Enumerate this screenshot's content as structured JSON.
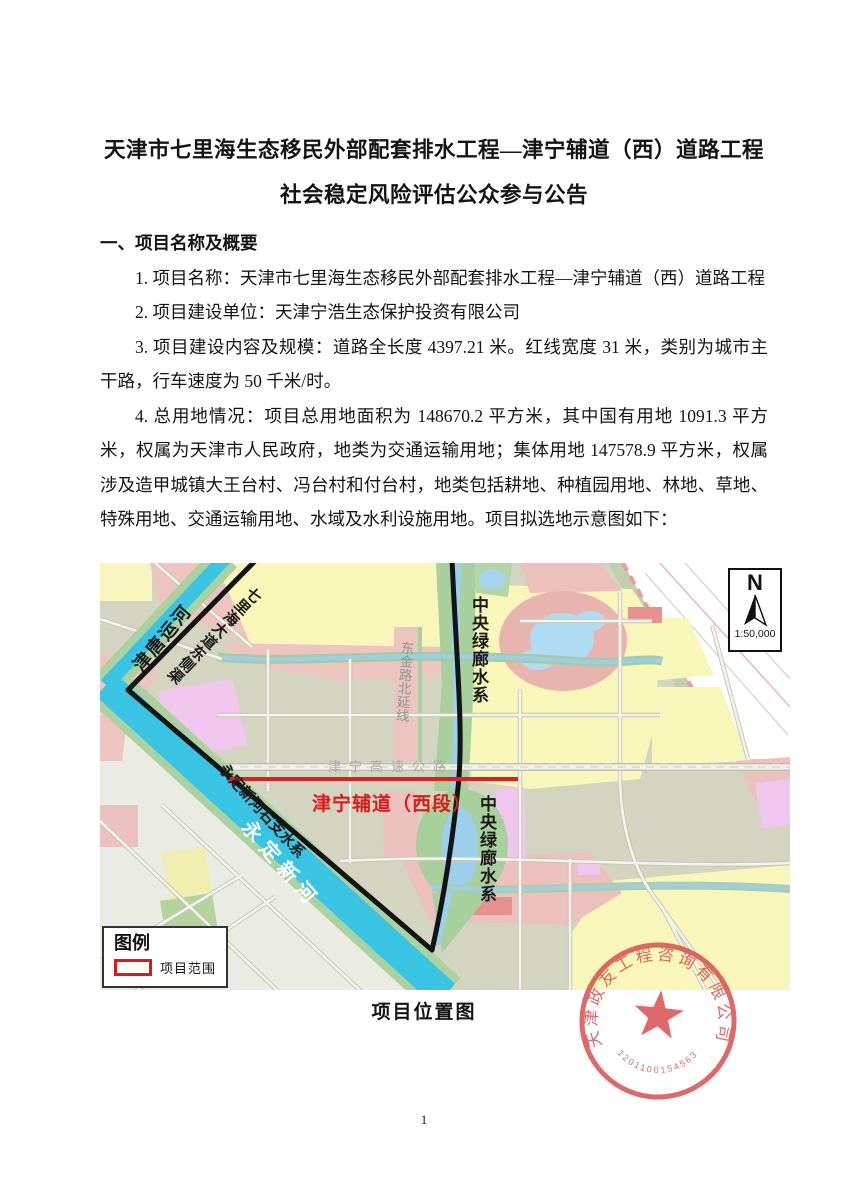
{
  "doc": {
    "title1": "天津市七里海生态移民外部配套排水工程—津宁辅道（西）道路工程",
    "title2": "社会稳定风险评估公众参与公告",
    "heading": "一、项目名称及概要",
    "p1": "1. 项目名称：天津市七里海生态移民外部配套排水工程—津宁辅道（西）道路工程",
    "p2": "2. 项目建设单位：天津宁浩生态保护投资有限公司",
    "p3": "3. 项目建设内容及规模：道路全长度 4397.21 米。红线宽度 31 米，类别为城市主干路，行车速度为 50 千米/时。",
    "p4": "4. 总用地情况：项目总用地面积为 148670.2 平方米，其中国有用地 1091.3 平方米，权属为天津市人民政府，地类为交通运输用地；集体用地 147578.9 平方米，权属涉及造甲城镇大王台村、冯台村和付台村，地类包括耕地、种植园用地、林地、草地、特殊用地、交通运输用地、水域及水利设施用地。项目拟选地示意图如下：",
    "caption": "项目位置图",
    "page_number": "1"
  },
  "map": {
    "labels": {
      "jintang_canal": "津唐运河",
      "qilihai_east_channel": "七里海大道东侧渠",
      "central_green_corridor": "中央绿廊水系",
      "dongjin_road_ext": "东金路北延线",
      "jinning_expressway": "津宁高速公路",
      "project_road": "津宁辅道（西段）",
      "yongding_right_branch": "永定新河右支水系",
      "yongding_river": "永定新河"
    },
    "north": "N",
    "scale": "1:50,000",
    "legend": {
      "title": "图例",
      "item": "项目范围"
    },
    "colors": {
      "project_line": "#df1f1f",
      "boundary": "#141414",
      "river": "#3ac4e4",
      "seal": "#d94848"
    }
  },
  "stamp": {
    "company": "天津政友工程咨询有限公司",
    "number": "1201100154563"
  }
}
